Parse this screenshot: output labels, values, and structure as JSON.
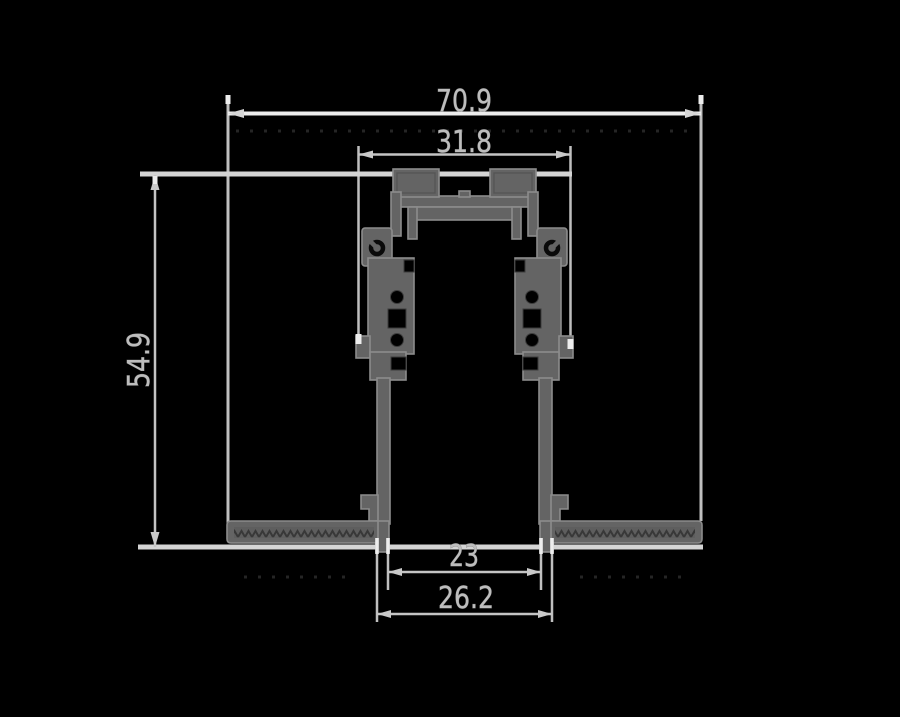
{
  "colors": {
    "background": "#000000",
    "profile_fill": "#646464",
    "profile_outline": "#8c8c8c",
    "dimension_lines": "#c2c2c2",
    "dimension_text": "#bdbdbd"
  },
  "dimensions": {
    "overall_width": {
      "label": "70.9"
    },
    "upper_body_width": {
      "label": "31.8"
    },
    "overall_height": {
      "label": "54.9"
    },
    "channel_inner_width": {
      "label": "23"
    },
    "channel_outer_width": {
      "label": "26.2"
    }
  }
}
